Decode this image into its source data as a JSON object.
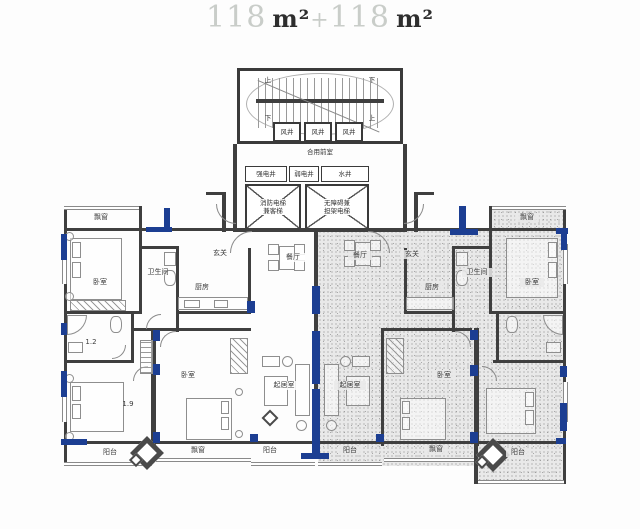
{
  "title": {
    "area_left": "118",
    "unit_left": "m²",
    "plus": "+",
    "area_right": "118",
    "unit_right": "m²"
  },
  "colors": {
    "structure_blue": "#1c3e92",
    "stipple_bg": "#e9e9e9",
    "wall": "#3f3f3f"
  },
  "core": {
    "stair_up": "上",
    "stair_down": "下",
    "wind_shaft": "风井",
    "shared_lobby": "合用前室",
    "shaft_strong": "强电井",
    "shaft_weak": "弱电井",
    "shaft_water": "水井",
    "elev_fire_l1": "消防电梯",
    "elev_fire_l2": "兼客梯",
    "elev_acc_l1": "无障碍兼",
    "elev_acc_l2": "担架电梯"
  },
  "labels": {
    "bay_window": "飘窗",
    "bedroom": "卧室",
    "bathroom": "卫生间",
    "entry": "玄关",
    "kitchen": "厨房",
    "dining": "餐厅",
    "living": "起居室",
    "balcony": "阳台",
    "dim_small_bath": "1.2",
    "dim_bed": "1.9"
  }
}
